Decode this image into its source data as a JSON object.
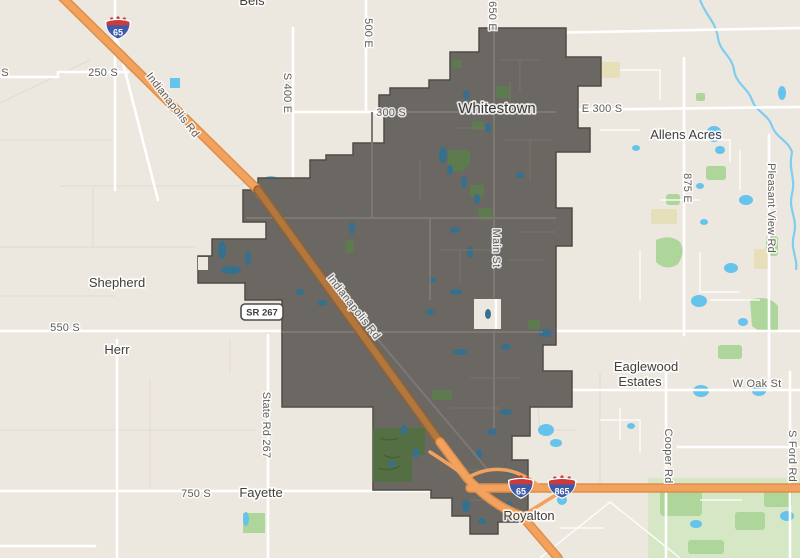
{
  "map": {
    "region_name": "Whitestown",
    "colors": {
      "background": "#ece7df",
      "field_line": "#e2ddd3",
      "road_white": "#ffffff",
      "road_inner": "#7d7873",
      "boundary_fill": "#6b6762",
      "boundary_stroke": "#4f4b47",
      "highway_fill": "#f2a25c",
      "highway_casing": "#dd8f49",
      "highway_muted_fill": "#b1773f",
      "highway_muted_casing": "#93622f",
      "water_bright": "#66c3ec",
      "water_muted": "#35708e",
      "park_bright": "#aed69a",
      "park_light": "#d5e7c5",
      "park_muted": "#5e7b4f",
      "golf_green": "#546f43",
      "khaki": "#e7dfb9",
      "shield_blue": "#3e5ba9",
      "shield_red": "#cc3a3a",
      "label_road": "#5f5e5c",
      "label_place": "#42403c"
    },
    "place_labels": [
      {
        "text": "Bels",
        "x": 252,
        "y": 5,
        "partial": true
      },
      {
        "text": "Whitestown",
        "x": 497,
        "y": 113,
        "big": true
      },
      {
        "text": "Allens Acres",
        "x": 686,
        "y": 139
      },
      {
        "text": "Shepherd",
        "x": 117,
        "y": 287
      },
      {
        "text": "Herr",
        "x": 117,
        "y": 354
      },
      {
        "text": "Eaglewood",
        "x": 646,
        "y": 371
      },
      {
        "text": "Estates",
        "x": 640,
        "y": 386
      },
      {
        "text": "Fayette",
        "x": 261,
        "y": 497
      },
      {
        "text": "Royalton",
        "x": 529,
        "y": 520
      }
    ],
    "road_labels": [
      {
        "text": "S",
        "x": 5,
        "y": 76
      },
      {
        "text": "250 S",
        "x": 103,
        "y": 76
      },
      {
        "text": "Indianapolis Rd",
        "x": 170,
        "y": 107,
        "rotate": 52
      },
      {
        "text": "Indianapolis Rd",
        "x": 351,
        "y": 309,
        "rotate": 52
      },
      {
        "text": "S 400 E",
        "x": 284,
        "y": 93,
        "rotate": 90
      },
      {
        "text": "500 E",
        "x": 365,
        "y": 33,
        "rotate": 90
      },
      {
        "text": "650 E",
        "x": 489,
        "y": 16,
        "rotate": 90
      },
      {
        "text": "300 S",
        "x": 391,
        "y": 116
      },
      {
        "text": "E 300 S",
        "x": 602,
        "y": 112
      },
      {
        "text": "Main St",
        "x": 493,
        "y": 248,
        "rotate": 90
      },
      {
        "text": "875 E",
        "x": 684,
        "y": 188,
        "rotate": 90
      },
      {
        "text": "Pleasant View Rd",
        "x": 768,
        "y": 208,
        "rotate": 90
      },
      {
        "text": "550 S",
        "x": 65,
        "y": 331
      },
      {
        "text": "State Rd 267",
        "x": 263,
        "y": 425,
        "rotate": 90
      },
      {
        "text": "750 S",
        "x": 196,
        "y": 497
      },
      {
        "text": "W Oak St",
        "x": 757,
        "y": 387
      },
      {
        "text": "Cooper Rd",
        "x": 665,
        "y": 456,
        "rotate": 90
      },
      {
        "text": "S Ford Rd",
        "x": 789,
        "y": 456,
        "rotate": 90
      }
    ],
    "shields": [
      {
        "kind": "interstate",
        "text": "65",
        "x": 118,
        "y": 29
      },
      {
        "kind": "interstate",
        "text": "65",
        "x": 521,
        "y": 488
      },
      {
        "kind": "interstate",
        "text": "865",
        "x": 562,
        "y": 488
      },
      {
        "kind": "state",
        "text": "SR 267",
        "x": 262,
        "y": 312
      }
    ]
  }
}
